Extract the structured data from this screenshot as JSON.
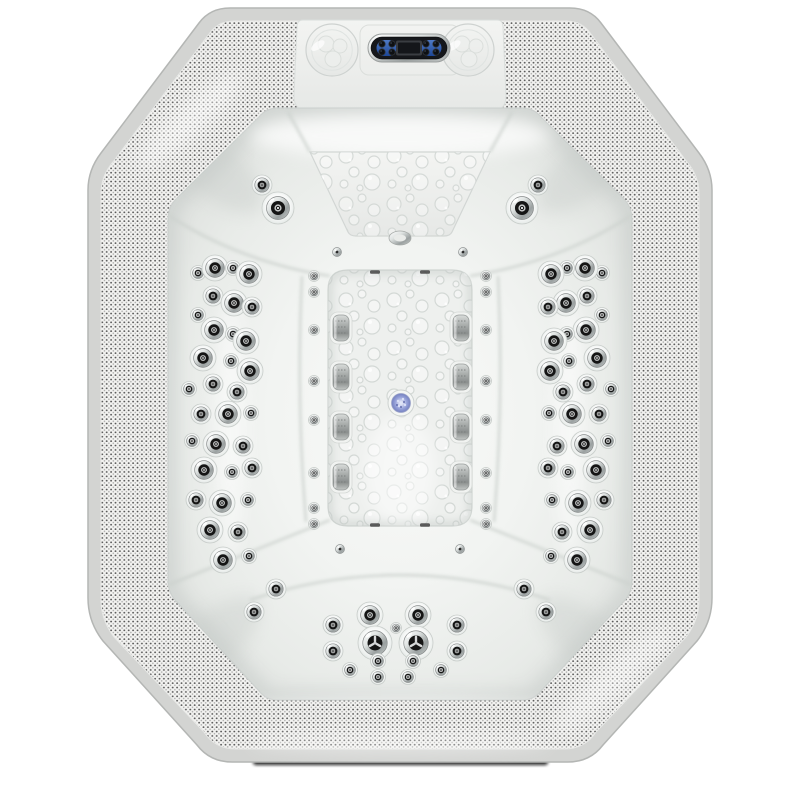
{
  "subject": "octagonal-hot-tub-spa-top-view",
  "colors": {
    "background": "#ffffff",
    "outer_border": "#d3d4d2",
    "outer_border_edge": "#b4b6b4",
    "perforation_base": "#f3f3f1",
    "perforation_dot_dark": "#3f3f3f",
    "perforation_dot_mid": "#6f6f6f",
    "shell_light": "#f8f9f7",
    "shell_mid": "#eef0ee",
    "shell_shadow": "#c3c8c5",
    "chrome_light": "#ffffff",
    "chrome_dark": "#8e9292",
    "jet_center": "#151515",
    "panel_face": "#15171b",
    "panel_accent_blue": "#2f62c4",
    "drain_light_blue": "#8d99d4",
    "floor_shadow": "#101010"
  },
  "jet_sizes": {
    "xl": 16,
    "l": 13,
    "m": 10,
    "s": 7.5,
    "xs": 5.5,
    "spin": 17
  },
  "jets": {
    "left_wall": [
      [
        198,
        273,
        "s"
      ],
      [
        215,
        268,
        "l"
      ],
      [
        233,
        268,
        "s"
      ],
      [
        249,
        274,
        "l"
      ],
      [
        213,
        296,
        "m"
      ],
      [
        234,
        303,
        "l"
      ],
      [
        252,
        307,
        "m"
      ],
      [
        198,
        315,
        "s"
      ],
      [
        214,
        330,
        "l"
      ],
      [
        233,
        334,
        "s"
      ],
      [
        246,
        341,
        "l"
      ],
      [
        203,
        358,
        "l"
      ],
      [
        231,
        361,
        "s"
      ],
      [
        250,
        371,
        "l"
      ],
      [
        189,
        389,
        "s"
      ],
      [
        213,
        384,
        "m"
      ],
      [
        237,
        392,
        "m"
      ],
      [
        201,
        414,
        "m"
      ],
      [
        228,
        414,
        "l"
      ],
      [
        251,
        413,
        "s"
      ],
      [
        192,
        441,
        "s"
      ],
      [
        216,
        444,
        "l"
      ],
      [
        243,
        446,
        "m"
      ],
      [
        204,
        470,
        "l"
      ],
      [
        232,
        472,
        "s"
      ],
      [
        252,
        468,
        "m"
      ],
      [
        196,
        500,
        "m"
      ],
      [
        222,
        503,
        "l"
      ],
      [
        248,
        500,
        "s"
      ],
      [
        210,
        530,
        "l"
      ],
      [
        238,
        532,
        "m"
      ],
      [
        223,
        560,
        "l"
      ],
      [
        249,
        556,
        "s"
      ]
    ],
    "top_wall_left": [
      [
        262,
        185,
        "m"
      ],
      [
        278,
        208,
        "xl"
      ]
    ],
    "bottom_wall_left": [
      [
        276,
        589,
        "m"
      ],
      [
        254,
        612,
        "m"
      ]
    ],
    "bottom_seat": [
      [
        370,
        615,
        "l"
      ],
      [
        418,
        615,
        "l"
      ],
      [
        333,
        625,
        "m"
      ],
      [
        457,
        625,
        "m"
      ],
      [
        396,
        628,
        "xs"
      ],
      [
        375,
        643,
        "spin"
      ],
      [
        416,
        643,
        "spin"
      ],
      [
        333,
        651,
        "m"
      ],
      [
        457,
        651,
        "m"
      ],
      [
        378,
        661,
        "s"
      ],
      [
        413,
        661,
        "s"
      ],
      [
        350,
        670,
        "s"
      ],
      [
        441,
        670,
        "s"
      ],
      [
        378,
        677,
        "s"
      ],
      [
        408,
        677,
        "s"
      ]
    ],
    "mini_column_left_x": 314,
    "mini_column_right_x": 486,
    "mini_column_ys": [
      276,
      292,
      330,
      381,
      420,
      473,
      508,
      524
    ],
    "mirror_axis_x": 400
  },
  "pillow_jets": {
    "left_x": 341,
    "right_x": 461,
    "ys": [
      328,
      377,
      427,
      477
    ],
    "width": 16,
    "height": 26
  },
  "fittings": {
    "oval_fitting": [
      400,
      238
    ],
    "chrome_balls": [
      [
        337,
        252
      ],
      [
        463,
        252
      ],
      [
        340,
        549
      ],
      [
        460,
        549
      ]
    ],
    "dark_slots": [
      [
        375,
        272
      ],
      [
        425,
        272
      ],
      [
        375,
        525
      ],
      [
        425,
        525
      ]
    ]
  },
  "drain_light": {
    "x": 401,
    "y": 403,
    "r": 13
  },
  "deck": {
    "speakers": [
      {
        "x": 332,
        "y": 50,
        "r": 26
      },
      {
        "x": 468,
        "y": 50,
        "r": 26
      }
    ]
  },
  "control_panel": {
    "x": 368,
    "y": 34,
    "width": 82,
    "height": 28,
    "lcd": {
      "x": 396,
      "y": 40.5,
      "width": 26,
      "height": 15
    },
    "buttons_left": [
      [
        382,
        44
      ],
      [
        392,
        44
      ],
      [
        382,
        52
      ],
      [
        392,
        52
      ]
    ],
    "buttons_right": [
      [
        426,
        44
      ],
      [
        436,
        44
      ],
      [
        426,
        52
      ],
      [
        436,
        52
      ]
    ]
  }
}
